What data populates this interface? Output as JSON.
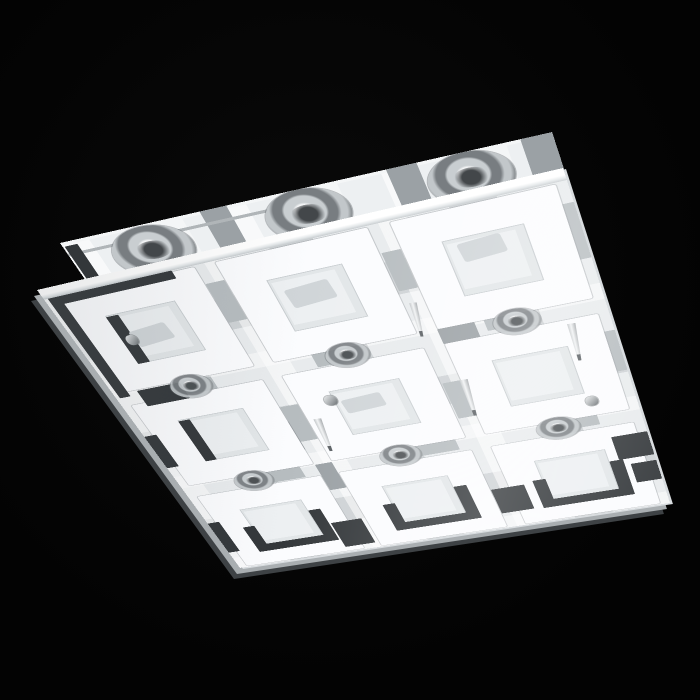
{
  "meta": {
    "type": "product-photo",
    "subject": "Square ceiling light fixture, tilted in perspective on a black background: mirrored mounting plate behind a glass diffuser panel printed with a 3x3 grid of frosted white square rings, grey plaid translucent squares, dark charcoal corner brackets and chrome halogen lamp fittings",
    "background": "#040404"
  },
  "palette": {
    "background": "#040404",
    "glass_base": "#e8ebed",
    "ring_white": "#fbfcfe",
    "hole_grey": "#e2e6e8",
    "accent_dark": "#33373a",
    "pattern_mid": "#b6bcbf",
    "pattern_mid2": "#9ba1a5",
    "pattern_light": "#f4f6f7",
    "chrome_light": "#f5f6f7",
    "chrome_dark": "#5f6467",
    "edge_light": "#d9dde0",
    "edge_mid": "#a9aeb1",
    "edge_dark": "#3e4245"
  },
  "counts": {
    "rings": 9,
    "plate_lamps_visible": 3,
    "through_glass_lamps_visible": 6,
    "mounting_pins_visible": 4
  },
  "backplate": {
    "blocks": [
      {
        "x": 0,
        "y": 0,
        "w": 500,
        "h": 4,
        "t": "light",
        "n": "plate-edge-highlight"
      },
      {
        "x": 0,
        "y": 16,
        "w": 240,
        "h": 4,
        "t": "line",
        "n": "plate-edge-line"
      },
      {
        "x": 2,
        "y": 6,
        "w": 14,
        "h": 52,
        "t": "dark",
        "n": "plate-left-edge"
      },
      {
        "x": 64,
        "y": 24,
        "w": 40,
        "h": 42,
        "t": "mid",
        "n": "pattern-square"
      },
      {
        "x": 150,
        "y": 0,
        "w": 28,
        "h": 66,
        "t": "mid2",
        "n": "pattern-square"
      },
      {
        "x": 226,
        "y": 10,
        "w": 44,
        "h": 48,
        "t": "mid",
        "n": "pattern-square"
      },
      {
        "x": 340,
        "y": 0,
        "w": 30,
        "h": 60,
        "t": "mid2",
        "n": "pattern-square"
      },
      {
        "x": 408,
        "y": 8,
        "w": 40,
        "h": 46,
        "t": "mid",
        "n": "pattern-square"
      },
      {
        "x": 470,
        "y": 0,
        "w": 30,
        "h": 50,
        "t": "mid2",
        "n": "pattern-square"
      },
      {
        "x": 100,
        "y": 0,
        "w": 30,
        "h": 60,
        "t": "light",
        "n": "pattern-square"
      },
      {
        "x": 260,
        "y": 0,
        "w": 30,
        "h": 62,
        "t": "light",
        "n": "pattern-square"
      },
      {
        "x": 430,
        "y": 0,
        "w": 26,
        "h": 56,
        "t": "light",
        "n": "pattern-square"
      }
    ],
    "bulbs": [
      {
        "x": 42,
        "y": 2,
        "w": 86,
        "h": 70,
        "n": "halogen-lamp"
      },
      {
        "x": 207,
        "y": 0,
        "w": 86,
        "h": 70,
        "n": "halogen-lamp"
      },
      {
        "x": 372,
        "y": 0,
        "w": 84,
        "h": 68,
        "n": "halogen-lamp"
      }
    ]
  },
  "glass": {
    "rings": [
      {
        "x": 10,
        "y": 16,
        "n": "ring-r1c1"
      },
      {
        "x": 177,
        "y": 16,
        "n": "ring-r1c2"
      },
      {
        "x": 344,
        "y": 16,
        "n": "ring-r1c3"
      },
      {
        "x": 10,
        "y": 184,
        "n": "ring-r2c1"
      },
      {
        "x": 177,
        "y": 184,
        "n": "ring-r2c2"
      },
      {
        "x": 344,
        "y": 184,
        "n": "ring-r2c3"
      },
      {
        "x": 10,
        "y": 352,
        "n": "ring-r3c1"
      },
      {
        "x": 177,
        "y": 352,
        "n": "ring-r3c2"
      },
      {
        "x": 344,
        "y": 352,
        "n": "ring-r3c3"
      }
    ],
    "blocks": [
      {
        "x": 4,
        "y": 14,
        "w": 12,
        "h": 156,
        "t": "dark",
        "n": "edge-frame-left"
      },
      {
        "x": 4,
        "y": 14,
        "w": 130,
        "h": 11,
        "t": "dark",
        "n": "edge-frame-top"
      },
      {
        "x": 46,
        "y": 54,
        "w": 13,
        "h": 72,
        "t": "dark",
        "n": "accent-bar"
      },
      {
        "x": 26,
        "y": 164,
        "w": 48,
        "h": 26,
        "t": "dark",
        "n": "accent-square"
      },
      {
        "x": 46,
        "y": 222,
        "w": 13,
        "h": 72,
        "t": "dark",
        "n": "accent-bar"
      },
      {
        "x": 0,
        "y": 236,
        "w": 14,
        "h": 58,
        "t": "dark",
        "n": "edge-accent"
      },
      {
        "x": 0,
        "y": 404,
        "w": 14,
        "h": 62,
        "t": "dark",
        "n": "edge-accent"
      },
      {
        "x": 36,
        "y": 422,
        "w": 14,
        "h": 52,
        "t": "dark",
        "n": "bracket-left"
      },
      {
        "x": 36,
        "y": 460,
        "w": 98,
        "h": 14,
        "t": "dark",
        "n": "bracket-bottom"
      },
      {
        "x": 120,
        "y": 410,
        "w": 14,
        "h": 64,
        "t": "dark",
        "n": "bracket-right"
      },
      {
        "x": 203,
        "y": 422,
        "w": 14,
        "h": 52,
        "t": "dark",
        "n": "bracket-left"
      },
      {
        "x": 203,
        "y": 460,
        "w": 98,
        "h": 14,
        "t": "dark",
        "n": "bracket-bottom"
      },
      {
        "x": 287,
        "y": 410,
        "w": 14,
        "h": 64,
        "t": "dark",
        "n": "bracket-right"
      },
      {
        "x": 370,
        "y": 422,
        "w": 14,
        "h": 52,
        "t": "dark",
        "n": "bracket-left"
      },
      {
        "x": 370,
        "y": 460,
        "w": 98,
        "h": 14,
        "t": "dark",
        "n": "bracket-bottom"
      },
      {
        "x": 454,
        "y": 410,
        "w": 14,
        "h": 64,
        "t": "dark",
        "n": "bracket-right"
      },
      {
        "x": 136,
        "y": 440,
        "w": 36,
        "h": 50,
        "t": "dark",
        "n": "accent-square"
      },
      {
        "x": 324,
        "y": 426,
        "w": 36,
        "h": 46,
        "t": "dark",
        "n": "accent-square"
      },
      {
        "x": 464,
        "y": 370,
        "w": 36,
        "h": 40,
        "t": "dark",
        "n": "accent-square"
      },
      {
        "x": 474,
        "y": 420,
        "w": 26,
        "h": 34,
        "t": "dark",
        "n": "accent-square"
      },
      {
        "x": 60,
        "y": 164,
        "w": 48,
        "h": 20,
        "t": "mid",
        "n": "pattern-square"
      },
      {
        "x": 216,
        "y": 160,
        "w": 52,
        "h": 22,
        "t": "mid",
        "n": "pattern-square"
      },
      {
        "x": 388,
        "y": 156,
        "w": 48,
        "h": 22,
        "t": "mid",
        "n": "pattern-square"
      },
      {
        "x": 96,
        "y": 330,
        "w": 44,
        "h": 20,
        "t": "mid",
        "n": "pattern-square"
      },
      {
        "x": 262,
        "y": 326,
        "w": 50,
        "h": 22,
        "t": "mid",
        "n": "pattern-square"
      },
      {
        "x": 414,
        "y": 326,
        "w": 44,
        "h": 20,
        "t": "mid",
        "n": "pattern-square"
      },
      {
        "x": 157,
        "y": 40,
        "w": 19,
        "h": 56,
        "t": "mid",
        "n": "pattern-square"
      },
      {
        "x": 157,
        "y": 230,
        "w": 19,
        "h": 60,
        "t": "mid",
        "n": "pattern-square"
      },
      {
        "x": 325,
        "y": 50,
        "w": 18,
        "h": 52,
        "t": "mid",
        "n": "pattern-square"
      },
      {
        "x": 325,
        "y": 240,
        "w": 18,
        "h": 58,
        "t": "mid",
        "n": "pattern-square"
      },
      {
        "x": 470,
        "y": 40,
        "w": 30,
        "h": 70,
        "t": "mid",
        "n": "pattern-square"
      },
      {
        "x": 476,
        "y": 210,
        "w": 24,
        "h": 60,
        "t": "mid",
        "n": "pattern-square"
      },
      {
        "x": 208,
        "y": 16,
        "w": 40,
        "h": 32,
        "t": "mid2",
        "n": "pattern-square"
      },
      {
        "x": 136,
        "y": 254,
        "w": 21,
        "h": 50,
        "t": "mid2",
        "n": "pattern-square"
      },
      {
        "x": 343,
        "y": 162,
        "w": 36,
        "h": 22,
        "t": "mid2",
        "n": "pattern-square"
      },
      {
        "x": 157,
        "y": 332,
        "w": 19,
        "h": 48,
        "t": "mid2",
        "n": "pattern-square"
      },
      {
        "x": 58,
        "y": 78,
        "w": 40,
        "h": 24,
        "r": -6,
        "t": "glint",
        "n": "reflection-glint"
      },
      {
        "x": 224,
        "y": 68,
        "w": 44,
        "h": 26,
        "r": -5,
        "t": "glint",
        "n": "reflection-glint"
      },
      {
        "x": 392,
        "y": 58,
        "w": 40,
        "h": 24,
        "r": -5,
        "t": "glint",
        "n": "reflection-glint"
      },
      {
        "x": 220,
        "y": 236,
        "w": 42,
        "h": 22,
        "r": -4,
        "t": "glint",
        "n": "reflection-glint"
      },
      {
        "x": 134,
        "y": 18,
        "w": 22,
        "h": 40,
        "t": "light",
        "n": "pattern-square"
      },
      {
        "x": 300,
        "y": 28,
        "w": 22,
        "h": 40,
        "t": "light",
        "n": "pattern-square"
      }
    ],
    "bulbs": [
      {
        "x": 61,
        "y": 155,
        "w": 44,
        "h": 36,
        "n": "halogen-lamp-through-glass"
      },
      {
        "x": 228,
        "y": 155,
        "w": 44,
        "h": 36,
        "n": "halogen-lamp-through-glass"
      },
      {
        "x": 395,
        "y": 155,
        "w": 44,
        "h": 36,
        "n": "halogen-lamp-through-glass"
      },
      {
        "x": 61,
        "y": 323,
        "w": 44,
        "h": 36,
        "n": "halogen-lamp-through-glass"
      },
      {
        "x": 228,
        "y": 323,
        "w": 44,
        "h": 36,
        "n": "halogen-lamp-through-glass"
      },
      {
        "x": 395,
        "y": 323,
        "w": 44,
        "h": 36,
        "n": "halogen-lamp-through-glass"
      }
    ],
    "cones": [
      {
        "x": 178,
        "y": 258,
        "w": 13,
        "h": 56,
        "r": 5,
        "n": "mounting-pin"
      },
      {
        "x": 338,
        "y": 240,
        "w": 13,
        "h": 58,
        "r": 4,
        "n": "mounting-pin"
      },
      {
        "x": 324,
        "y": 120,
        "w": 11,
        "h": 48,
        "r": 7,
        "n": "mounting-pin"
      },
      {
        "x": 456,
        "y": 190,
        "w": 12,
        "h": 54,
        "r": 4,
        "n": "mounting-pin"
      }
    ],
    "screws": [
      {
        "x": 204,
        "y": 226,
        "w": 13,
        "h": 16,
        "n": "screw-cap"
      },
      {
        "x": 50,
        "y": 84,
        "w": 12,
        "h": 15,
        "n": "screw-cap"
      },
      {
        "x": 452,
        "y": 300,
        "w": 12,
        "h": 15,
        "n": "screw-cap"
      }
    ]
  }
}
